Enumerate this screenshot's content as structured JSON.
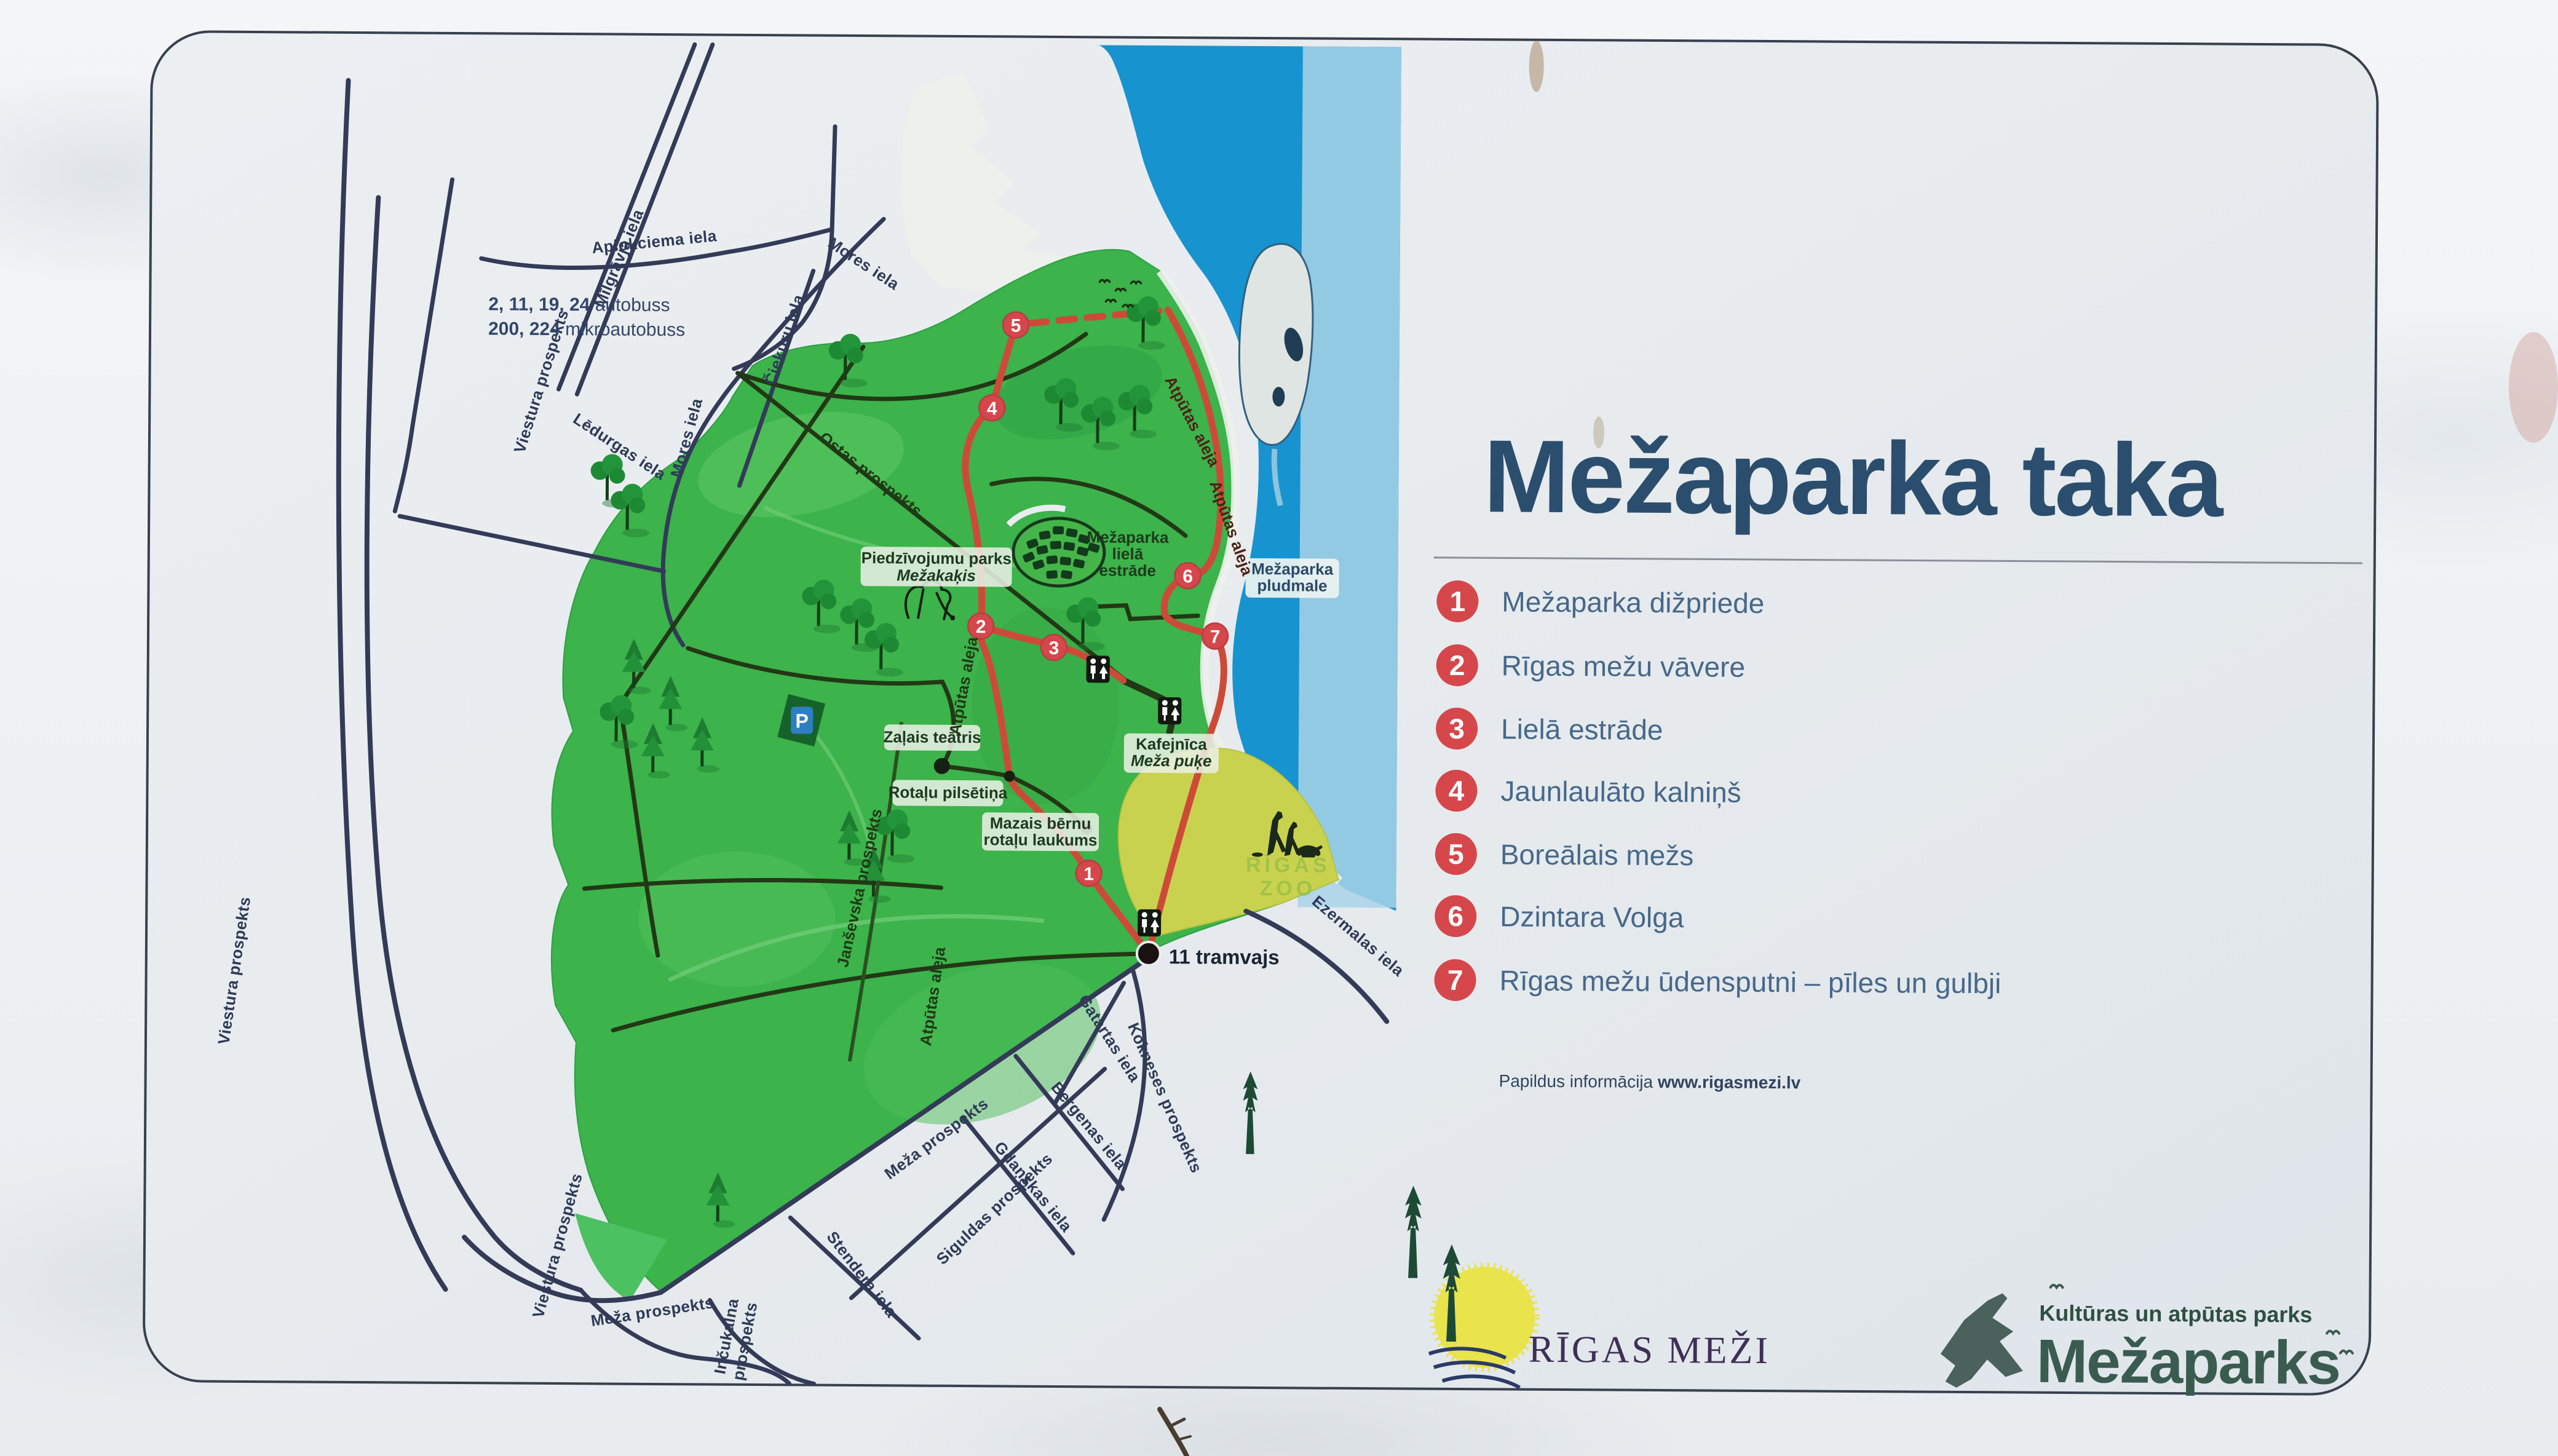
{
  "theme": {
    "title_blue": "#2c4e6e",
    "legend_text": "#47688a",
    "legend_circle_red": "#d5474b",
    "route_red": "#ce4a38",
    "water_blue": "#1793cf",
    "water_band": "#a9d3e6",
    "park_green": "#3cb34b",
    "zoo_green": "#c9d24f",
    "road_navy": "#333b58",
    "road_park": "#223816",
    "sign_bg": "#e9edf0"
  },
  "sign": {
    "title": "Mežaparka taka",
    "transit": {
      "line1_numbers": "2, 11, 19, 24",
      "line1_word": " autobuss",
      "line2_numbers": "200, 224",
      "line2_word": " mikroautobuss"
    },
    "legend": [
      {
        "num": "1",
        "label": "Mežaparka dižpriede"
      },
      {
        "num": "2",
        "label": "Rīgas mežu vāvere"
      },
      {
        "num": "3",
        "label": "Lielā estrāde"
      },
      {
        "num": "4",
        "label": "Jaunlaulāto kalniņš"
      },
      {
        "num": "5",
        "label": "Boreālais mežs"
      },
      {
        "num": "6",
        "label": "Dzintara Volga"
      },
      {
        "num": "7",
        "label": "Rīgas mežu ūdensputni – pīles un gulbji"
      }
    ],
    "info": {
      "prefix": "Papildus informācija ",
      "url": "www.rigasmezi.lv"
    },
    "logos": {
      "rigas_mezi": "RĪGAS MEŽI",
      "tagline": "Kultūras un atpūtas parks",
      "mezaparks": "Mežaparks"
    }
  },
  "map": {
    "streets": {
      "viestura": "Viestura prospekts",
      "milgravja": "Mīlgrāvja iela",
      "aplokciema": "Aplokciema iela",
      "ciekuru": "Čiekuru iela",
      "mores": "Mores iela",
      "ledurgas": "Lēdurgas iela",
      "ostas": "Ostas prospekts",
      "atputas": "Atpūtas aleja",
      "jansevska": "Janševska prospekts",
      "ezermalas": "Ezermalas iela",
      "gatartas": "Gatartas iela",
      "kokneses": "Kokneses prospekts",
      "bergenas": "Bergenas iela",
      "gdanskas": "Gdaņskas iela",
      "meza": "Meža prospekts",
      "siguldas": "Siguldas prospekts",
      "stendera": "Stendera iela",
      "incukalna_1": "Inčukalna",
      "incukalna_2": "prospekts"
    },
    "places": {
      "adventure1": "Piedzīvojumu parks",
      "adventure2": "Mežakaķis",
      "estrade1": "Mežaparka",
      "estrade2": "lielā",
      "estrade3": "estrāde",
      "beach1": "Mežaparka",
      "beach2": "pludmale",
      "green_theatre": "Zaļais teātris",
      "play_town": "Rotaļu pilsētiņa",
      "playground1": "Mazais bērnu",
      "playground2": "rotaļu laukums",
      "cafe1": "Kafejnīca",
      "cafe2": "Meža puķe",
      "tram": "11 tramvajs",
      "zoo1": "RĪGAS",
      "zoo2": "ZOO",
      "parking": "P"
    },
    "markers": [
      "1",
      "2",
      "3",
      "4",
      "5",
      "6",
      "7"
    ]
  }
}
